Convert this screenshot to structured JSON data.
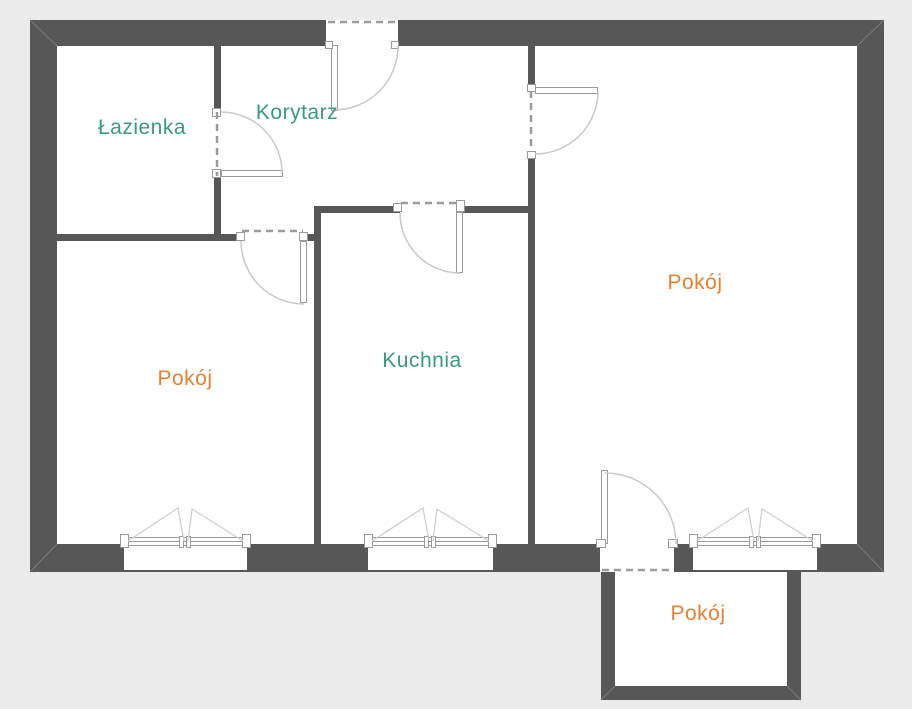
{
  "plan": {
    "rooms": [
      {
        "id": "lazienka",
        "label": "Łazienka",
        "label_color": "#3a9b7b"
      },
      {
        "id": "korytarz",
        "label": "Korytarz",
        "label_color": "#3a9b7b"
      },
      {
        "id": "kuchnia",
        "label": "Kuchnia",
        "label_color": "#3a9b7b"
      },
      {
        "id": "pokoj-left",
        "label": "Pokój",
        "label_color": "#e6812f"
      },
      {
        "id": "pokoj-right",
        "label": "Pokój",
        "label_color": "#e6812f"
      },
      {
        "id": "pokoj-bottom",
        "label": "Pokój",
        "label_color": "#e6812f"
      }
    ],
    "palette": {
      "background": "#ebebeb",
      "wall": "#575757",
      "floor": "#ffffff",
      "door_window_stroke": "#9a9a9a",
      "swing_arc": "#c9c9c9",
      "dashed_opening": "#9b9b9b"
    }
  }
}
